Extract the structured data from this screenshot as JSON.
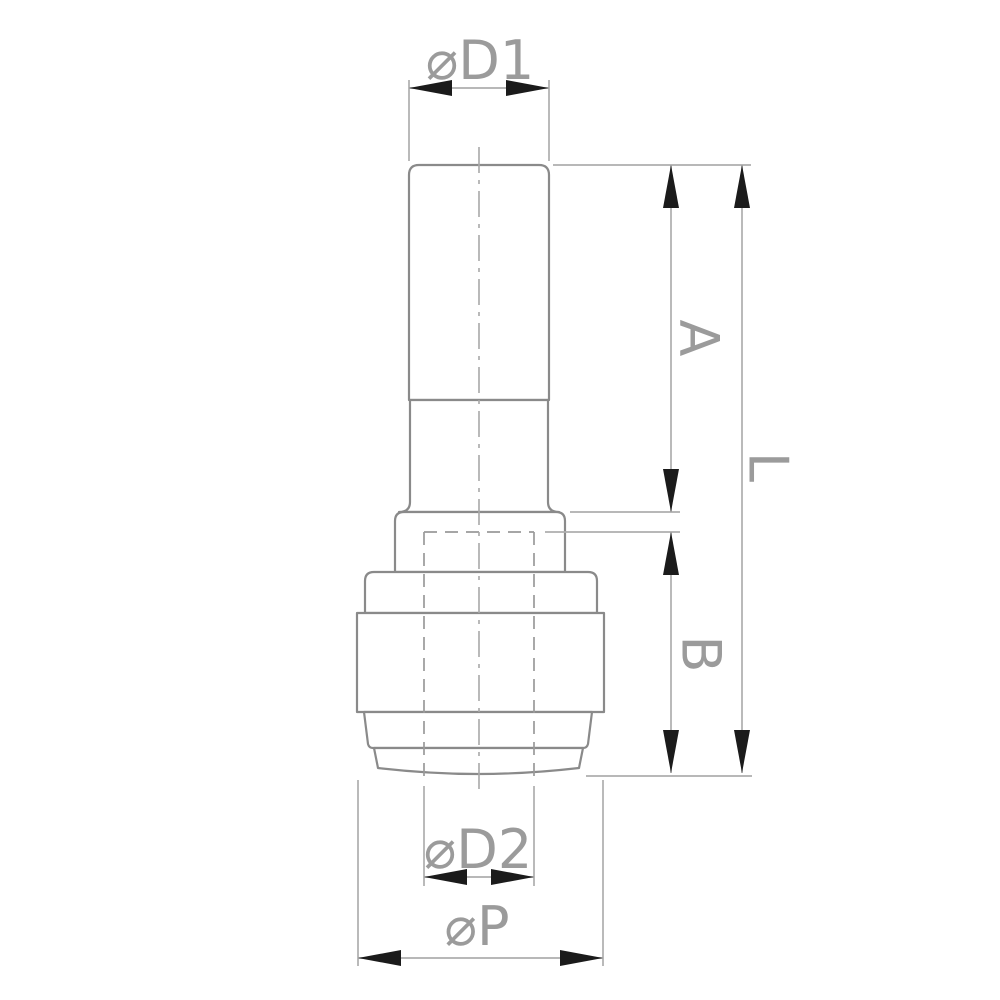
{
  "figure": {
    "kind": "technical-drawing",
    "view": "front-elevation-of-push-fit-reducer-fitting",
    "background_color": "#ffffff"
  },
  "colors": {
    "part_outline": "#8a8a8a",
    "thin_dimension_line": "#aeaeae",
    "hidden_line": "#9a9a9a",
    "arrowhead": "#1b1b1b",
    "label_text": "#9b9b9b"
  },
  "dimensions": {
    "d1": {
      "label": "⌀D1"
    },
    "a": {
      "label": "A"
    },
    "l": {
      "label": "L"
    },
    "b": {
      "label": "B"
    },
    "d2": {
      "label": "⌀D2"
    },
    "p": {
      "label": "⌀P"
    }
  }
}
